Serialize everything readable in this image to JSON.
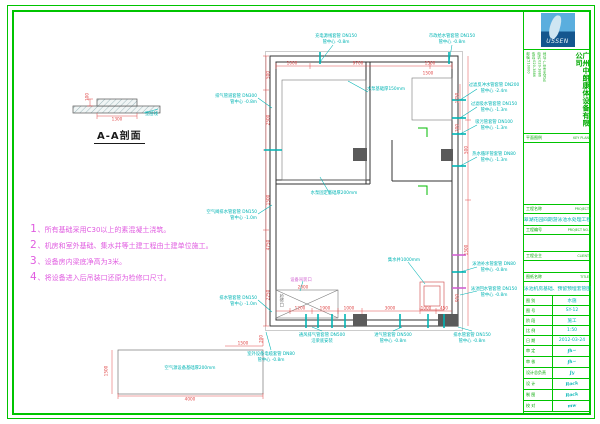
{
  "section_detail": {
    "title": "A-A剖面"
  },
  "notes": [
    {
      "num": "1",
      "text": "、所有基础采用C30以上的素混凝土浇筑。"
    },
    {
      "num": "2",
      "text": "、机房和室外基础、集水井等土建工程由土建单位施工。"
    },
    {
      "num": "3",
      "text": "、设备房内梁底净高为3米。"
    },
    {
      "num": "4",
      "text": "、将设备进入后吊装口还原为检修口尺寸。"
    }
  ],
  "colors": {
    "frame_green": "#00c400",
    "annotation_cyan": "#00b4b4",
    "dimension_red": "#e04848",
    "notes_magenta": "#e05ce0",
    "logo_blue": "#14568e"
  },
  "plan_annotations": [
    {
      "x": 336,
      "y": 34,
      "a": "c",
      "lines": [
        "充电源线套管 DN150",
        "管中心 -0.8m"
      ]
    },
    {
      "x": 452,
      "y": 34,
      "a": "c",
      "lines": [
        "市政给水管套管 DN150",
        "管中心 -0.8m"
      ]
    },
    {
      "x": 257,
      "y": 94,
      "a": "r",
      "lines": [
        "排气管道套管 DN300",
        "管中心 -0.8m"
      ]
    },
    {
      "x": 257,
      "y": 210,
      "a": "r",
      "lines": [
        "空气阀排水管套管 DN150",
        "管中心 -1.0m"
      ]
    },
    {
      "x": 257,
      "y": 296,
      "a": "r",
      "lines": [
        "排水管套管 DN150",
        "管中心 -1.0m"
      ]
    },
    {
      "x": 386,
      "y": 87,
      "a": "c",
      "lines": [
        "水泵基础厚150mm"
      ]
    },
    {
      "x": 334,
      "y": 191,
      "a": "c",
      "lines": [
        "水泵固定基础厚200mm"
      ]
    },
    {
      "x": 404,
      "y": 258,
      "a": "c",
      "lines": [
        "集水井1000mm"
      ]
    },
    {
      "x": 301,
      "y": 278,
      "a": "c",
      "color": "#d060d0",
      "lines": [
        "设备吊装口"
      ]
    },
    {
      "x": 281,
      "y": 294,
      "a": "c",
      "color": "#707070",
      "vertical": true,
      "lines": [
        "检修口"
      ]
    },
    {
      "x": 322,
      "y": 333,
      "a": "c",
      "lines": [
        "通风排气管套管 DN500",
        "沿梁底安装"
      ]
    },
    {
      "x": 393,
      "y": 333,
      "a": "c",
      "lines": [
        "进气管套管 DN500",
        "管中心 -0.8m"
      ]
    },
    {
      "x": 472,
      "y": 333,
      "a": "c",
      "lines": [
        "排水管套管 DN150",
        "管中心 -0.8m"
      ]
    },
    {
      "x": 494,
      "y": 83,
      "a": "c",
      "lines": [
        "过滤反冲水管套管 DN200",
        "管中心 -2.4m"
      ]
    },
    {
      "x": 494,
      "y": 102,
      "a": "c",
      "lines": [
        "过滤吸水管套管 DN150",
        "管中心 -1.3m"
      ]
    },
    {
      "x": 494,
      "y": 120,
      "a": "c",
      "lines": [
        "吸污管套管 DN100",
        "管中心 -1.3m"
      ]
    },
    {
      "x": 494,
      "y": 152,
      "a": "c",
      "lines": [
        "热水循环管套管 DN80",
        "管中心 -1.3m"
      ]
    },
    {
      "x": 494,
      "y": 262,
      "a": "c",
      "lines": [
        "泳池补水管套管 DN80",
        "管中心 -0.8m"
      ]
    },
    {
      "x": 494,
      "y": 287,
      "a": "c",
      "lines": [
        "泳池回水管套管 DN150",
        "管中心 -0.8m"
      ]
    },
    {
      "x": 271,
      "y": 352,
      "a": "c",
      "lines": [
        "室外设备电缆套管 DN80",
        "管中心 -0.8m"
      ]
    },
    {
      "x": 190,
      "y": 366,
      "a": "c",
      "lines": [
        "空气源设备基础厚200mm"
      ]
    },
    {
      "x": 145,
      "y": 112,
      "a": "l",
      "lines": [
        "垫层线"
      ]
    }
  ],
  "dimensions": [
    {
      "x": 292,
      "y": 63,
      "t": "1000"
    },
    {
      "x": 358,
      "y": 63,
      "t": "9700"
    },
    {
      "x": 430,
      "y": 63,
      "t": "1500"
    },
    {
      "x": 428,
      "y": 73,
      "t": "1500"
    },
    {
      "x": 268,
      "y": 75,
      "t": "500",
      "r": 1
    },
    {
      "x": 268,
      "y": 120,
      "t": "2500",
      "r": 1
    },
    {
      "x": 268,
      "y": 200,
      "t": "1500",
      "r": 1
    },
    {
      "x": 268,
      "y": 245,
      "t": "4750",
      "r": 1
    },
    {
      "x": 268,
      "y": 295,
      "t": "2250",
      "r": 1
    },
    {
      "x": 457,
      "y": 98,
      "t": "1750",
      "r": 1
    },
    {
      "x": 457,
      "y": 128,
      "t": "200",
      "r": 1
    },
    {
      "x": 466,
      "y": 150,
      "t": "500",
      "r": 1
    },
    {
      "x": 466,
      "y": 250,
      "t": "1500",
      "r": 1
    },
    {
      "x": 457,
      "y": 298,
      "t": "950",
      "r": 1
    },
    {
      "x": 300,
      "y": 308,
      "t": "1200"
    },
    {
      "x": 325,
      "y": 308,
      "t": "1900"
    },
    {
      "x": 349,
      "y": 308,
      "t": "1000"
    },
    {
      "x": 390,
      "y": 308,
      "t": "3000"
    },
    {
      "x": 426,
      "y": 308,
      "t": "1000"
    },
    {
      "x": 444,
      "y": 308,
      "t": "450"
    },
    {
      "x": 303,
      "y": 287,
      "t": "2000"
    },
    {
      "x": 190,
      "y": 399,
      "t": "4000"
    },
    {
      "x": 106,
      "y": 371,
      "t": "1500",
      "r": 1
    },
    {
      "x": 243,
      "y": 343,
      "t": "1500"
    },
    {
      "x": 261,
      "y": 339,
      "t": "200",
      "r": 1
    },
    {
      "x": 117,
      "y": 119,
      "t": "1300"
    },
    {
      "x": 87,
      "y": 97,
      "t": "100",
      "r": 1
    }
  ],
  "titleblock": {
    "logo_text": "USSEN",
    "company": "广州中朗康体设备有限公司",
    "contact": [
      "地址:广州市天河区",
      "电话:020-3886",
      "传真:020-3886",
      "邮编:510000"
    ],
    "keyplan_label": "平面图例",
    "keyplan_en": "KEY PLAN",
    "project_label": "工程名称",
    "project_en": "PROJECT",
    "project_value": "翠湖花园四期游泳池水处理工程",
    "projectno_label": "工程编号",
    "projectno_en": "PROJECT NO.",
    "client_label": "工程业主",
    "client_en": "CLIENT",
    "title_label": "图纸名称",
    "title_en": "TITLE",
    "title_value": "泳池机房基础、预留预埋套管图",
    "pairs": [
      {
        "k": "图 别",
        "v": "水施"
      },
      {
        "k": "图 号",
        "v": "SY-12"
      },
      {
        "k": "阶 段",
        "v": "施工"
      },
      {
        "k": "比 例",
        "v": "1:50"
      },
      {
        "k": "日 期",
        "v": "2012-03-24"
      }
    ],
    "signs": [
      {
        "k": "审 定",
        "v": "fh~"
      },
      {
        "k": "审 核",
        "v": "fh~"
      },
      {
        "k": "设计总负责",
        "v": "Jy"
      },
      {
        "k": "设 计",
        "v": "Rock"
      },
      {
        "k": "制 图",
        "v": "Rock"
      },
      {
        "k": "校 对",
        "v": "mw"
      }
    ]
  }
}
